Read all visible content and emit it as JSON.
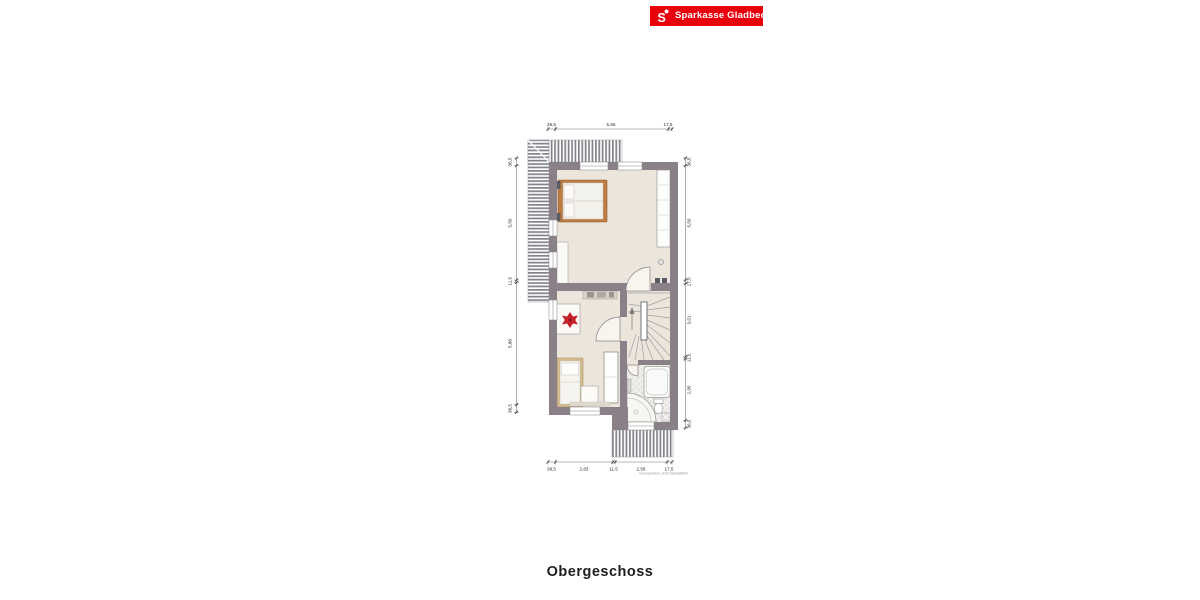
{
  "header": {
    "bank_name": "Sparkasse Gladbeck",
    "brand_color": "#e8000d",
    "logo_icon": "sparkasse-s-icon"
  },
  "floorplan": {
    "title": "Obergeschoss",
    "footnote": "Exemplarisch, nicht maßstäblich",
    "dimensions": {
      "top": [
        "36,5",
        "5,56",
        "17,5"
      ],
      "bottom": [
        "36,5",
        "2,83",
        "11,5",
        "2,56",
        "17,5"
      ],
      "left": [
        "36,5",
        "5,50",
        "11,5",
        "5,88",
        "36,5"
      ],
      "right": [
        "36,5",
        "5,50",
        "17,5",
        "3,51",
        "11,5",
        "2,95",
        "36,5"
      ]
    },
    "colors": {
      "wall": "#8a8188",
      "floor": "#ece5db",
      "roof_hatch": "#82828a",
      "tile": "#e7e5e1",
      "bed_frame": "#bd7c42",
      "accent_red": "#c4232b"
    }
  }
}
